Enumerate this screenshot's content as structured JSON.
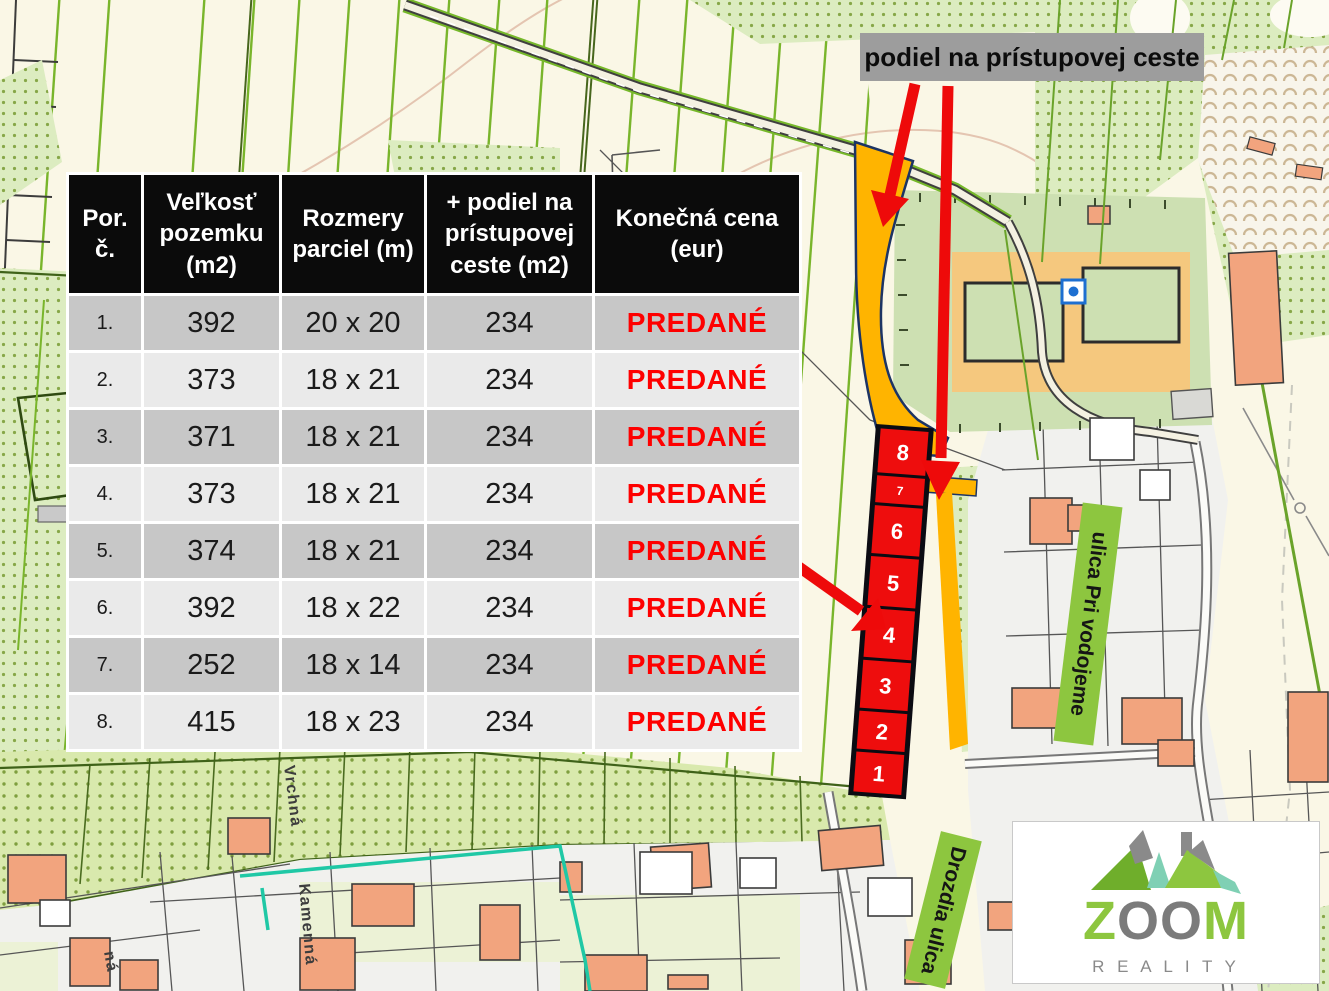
{
  "annotation": {
    "access_road_label": "podiel na prístupovej ceste"
  },
  "table": {
    "headers": [
      "Por. č.",
      "Veľkosť pozemku (m2)",
      "Rozmery parciel (m)",
      "+ podiel na prístupovej ceste (m2)",
      "Konečná cena (eur)"
    ],
    "rows": [
      {
        "num": "1.",
        "size": "392",
        "dimensions": "20 x 20",
        "road_share": "234",
        "price": "PREDANÉ"
      },
      {
        "num": "2.",
        "size": "373",
        "dimensions": "18 x 21",
        "road_share": "234",
        "price": "PREDANÉ"
      },
      {
        "num": "3.",
        "size": "371",
        "dimensions": "18 x 21",
        "road_share": "234",
        "price": "PREDANÉ"
      },
      {
        "num": "4.",
        "size": "373",
        "dimensions": "18 x 21",
        "road_share": "234",
        "price": "PREDANÉ"
      },
      {
        "num": "5.",
        "size": "374",
        "dimensions": "18 x 21",
        "road_share": "234",
        "price": "PREDANÉ"
      },
      {
        "num": "6.",
        "size": "392",
        "dimensions": "18 x 22",
        "road_share": "234",
        "price": "PREDANÉ"
      },
      {
        "num": "7.",
        "size": "252",
        "dimensions": "18 x 14",
        "road_share": "234",
        "price": "PREDANÉ"
      },
      {
        "num": "8.",
        "size": "415",
        "dimensions": "18 x 23",
        "road_share": "234",
        "price": "PREDANÉ"
      }
    ]
  },
  "map": {
    "parcels": [
      "8",
      "7",
      "6",
      "5",
      "4",
      "3",
      "2",
      "1"
    ],
    "street_labels": {
      "pri_vodojeme": "ulica Pri vodojeme",
      "drozdia": "Drozdia ulica"
    },
    "street_names": {
      "vrchna": "Vrchná",
      "kamenna": "Kamenná",
      "partial": "ná"
    }
  },
  "logo": {
    "z": "Z",
    "oo": "OO",
    "m": "M",
    "subtitle": "R E A L I T Y"
  },
  "colors": {
    "sold_red": "#fe0000",
    "parcel_red": "#ee0d0d",
    "access_orange": "#ffb400",
    "label_green": "#8dc63f",
    "annotation_gray": "#9d9d9d",
    "logo_green": "#8dc63f",
    "logo_gray": "#7b7b7b"
  }
}
